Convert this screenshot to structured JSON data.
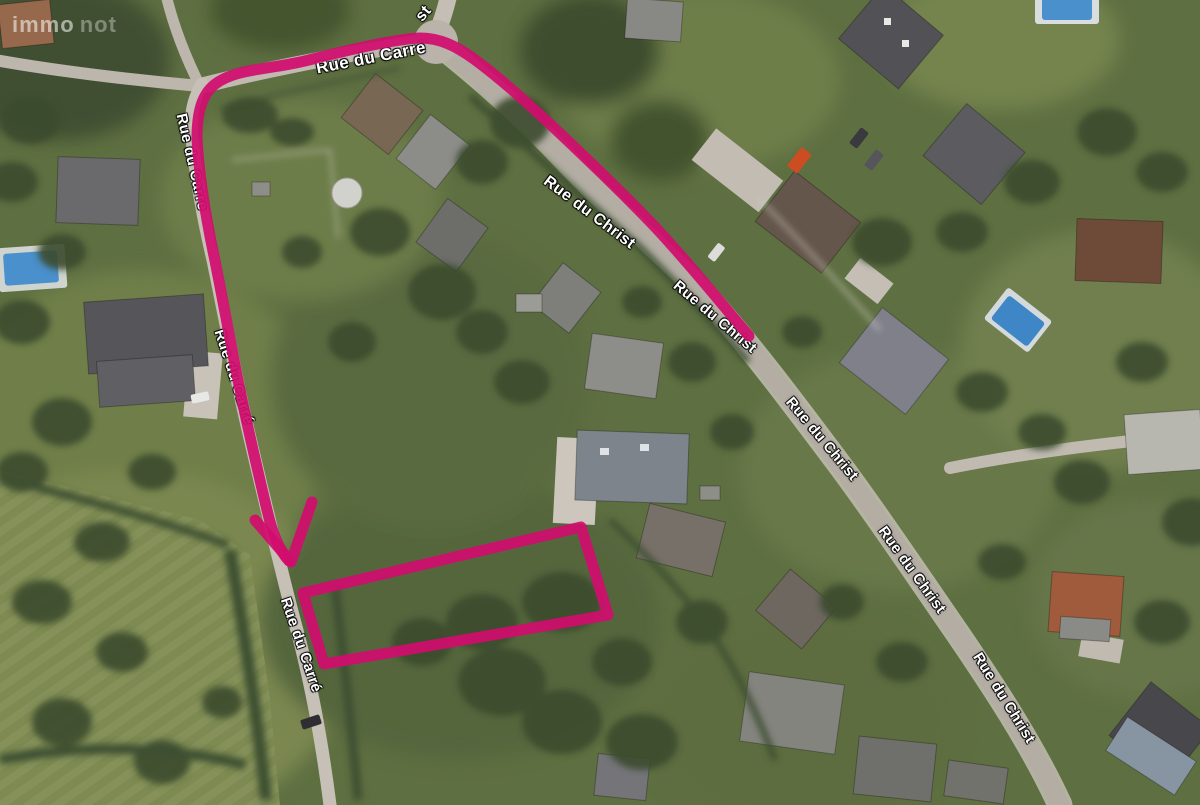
{
  "map": {
    "watermark": {
      "part1": "immo",
      "part2": "not"
    },
    "street_labels": [
      {
        "text": "st",
        "x": 424,
        "y": 14,
        "rotate": -50,
        "size": 16
      },
      {
        "text": "Rue du Carré",
        "x": 371,
        "y": 58,
        "rotate": -11,
        "size": 17
      },
      {
        "text": "Rue du Carre",
        "x": 192,
        "y": 162,
        "rotate": 77,
        "size": 15
      },
      {
        "text": "Rue du Carré",
        "x": 234,
        "y": 377,
        "rotate": 72,
        "size": 15
      },
      {
        "text": "Rue du Carré",
        "x": 301,
        "y": 645,
        "rotate": 71,
        "size": 15
      },
      {
        "text": "Rue du Christ",
        "x": 589,
        "y": 213,
        "rotate": 37,
        "size": 16
      },
      {
        "text": "Rue du Christ",
        "x": 715,
        "y": 317,
        "rotate": 40,
        "size": 15
      },
      {
        "text": "Rue du Christ",
        "x": 822,
        "y": 439,
        "rotate": 50,
        "size": 15
      },
      {
        "text": "Rue du Christ",
        "x": 912,
        "y": 570,
        "rotate": 54,
        "size": 15
      },
      {
        "text": "Rue du Christ",
        "x": 1004,
        "y": 698,
        "rotate": 58,
        "size": 15
      }
    ],
    "annotation": {
      "color": "#d10d6e",
      "route_path": "M 749,336 C 720,302 688,262 656,228 C 622,192 584,156 550,124 C 524,100 500,78 474,59 C 456,46 440,38 420,38 C 396,39 352,49 309,60 C 270,70 235,68 214,85 C 202,95 197,112 197,138 C 199,176 206,218 214,256 C 223,300 231,346 240,390 C 249,434 258,472 267,510 C 273,536 280,551 289,561",
      "arrowhead_path": "M 255,520 L 291,562 L 312,502",
      "parcel_points": "303,593 581,527 608,615 324,664"
    }
  }
}
